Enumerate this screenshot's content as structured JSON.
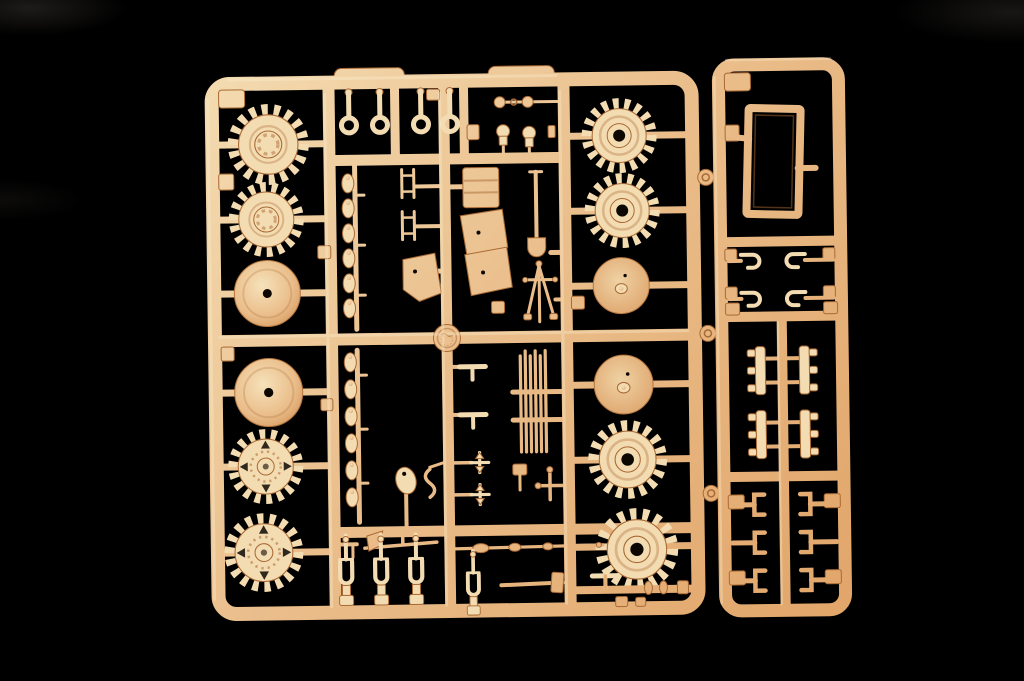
{
  "scene": {
    "description": "Photograph of a tan injection-molded plastic model kit sprue (parts tree) for an armored vehicle kit, lying on a black background",
    "background_label": "black backdrop"
  },
  "colors": {
    "background": "#000000",
    "plastic_light": "#f4dcb2",
    "plastic_mid": "#eabd8a",
    "plastic_deep": "#e0a265",
    "plastic_shadow": "#a96a35",
    "highlight": "#fbeccd",
    "hole_dark": "#0d0702",
    "wheel_center": "#f6e2ba",
    "wheel_rim": "#cf8f55",
    "disc_center": "#efd2a4",
    "disc_rim": "#dc9f66"
  },
  "sprue": {
    "material": "tan polystyrene",
    "layout": "large square main frame with internal runners plus a narrow right-hand frame joined by three connector stubs",
    "parts": [
      {
        "id": "sprocket-wheel",
        "label": "toothed sprocket wheel",
        "count": 8
      },
      {
        "id": "road-wheel",
        "label": "domed road wheel",
        "count": 2
      },
      {
        "id": "idler-disc",
        "label": "flat idler wheel disc",
        "count": 2
      },
      {
        "id": "tow-shackle",
        "label": "tow shackle pin with loop",
        "count": 4
      },
      {
        "id": "clevis-shackle",
        "label": "U-shaped clevis shackle",
        "count": 5
      },
      {
        "id": "suspension-strip",
        "label": "strip of six suspension arms",
        "count": 2
      },
      {
        "id": "hatch-frame",
        "label": "rectangular hatch frame",
        "count": 1
      },
      {
        "id": "stowage-box",
        "label": "stowage box",
        "count": 1
      },
      {
        "id": "shovel",
        "label": "shovel with long handle",
        "count": 1
      },
      {
        "id": "mattock",
        "label": "mattock / pick",
        "count": 1
      },
      {
        "id": "hammer",
        "label": "sledgehammer",
        "count": 1
      },
      {
        "id": "cleaning-rod",
        "label": "long cleaning rod",
        "count": 1
      },
      {
        "id": "rod-bundle",
        "label": "bundle of six thin rods",
        "count": 1
      },
      {
        "id": "tripod",
        "label": "tripod mount",
        "count": 1
      },
      {
        "id": "fender-plate",
        "label": "angled fender plate",
        "count": 2
      },
      {
        "id": "j-clip",
        "label": "J-shaped clip",
        "count": 4
      },
      {
        "id": "c-clamp",
        "label": "C-shaped tool clamp",
        "count": 6
      },
      {
        "id": "track-bracket",
        "label": "ribbed track bracket",
        "count": 4
      },
      {
        "id": "periscope-knob",
        "label": "small periscope knob",
        "count": 3
      },
      {
        "id": "maker-disc",
        "label": "round embossed maker's disc",
        "count": 1
      }
    ]
  }
}
